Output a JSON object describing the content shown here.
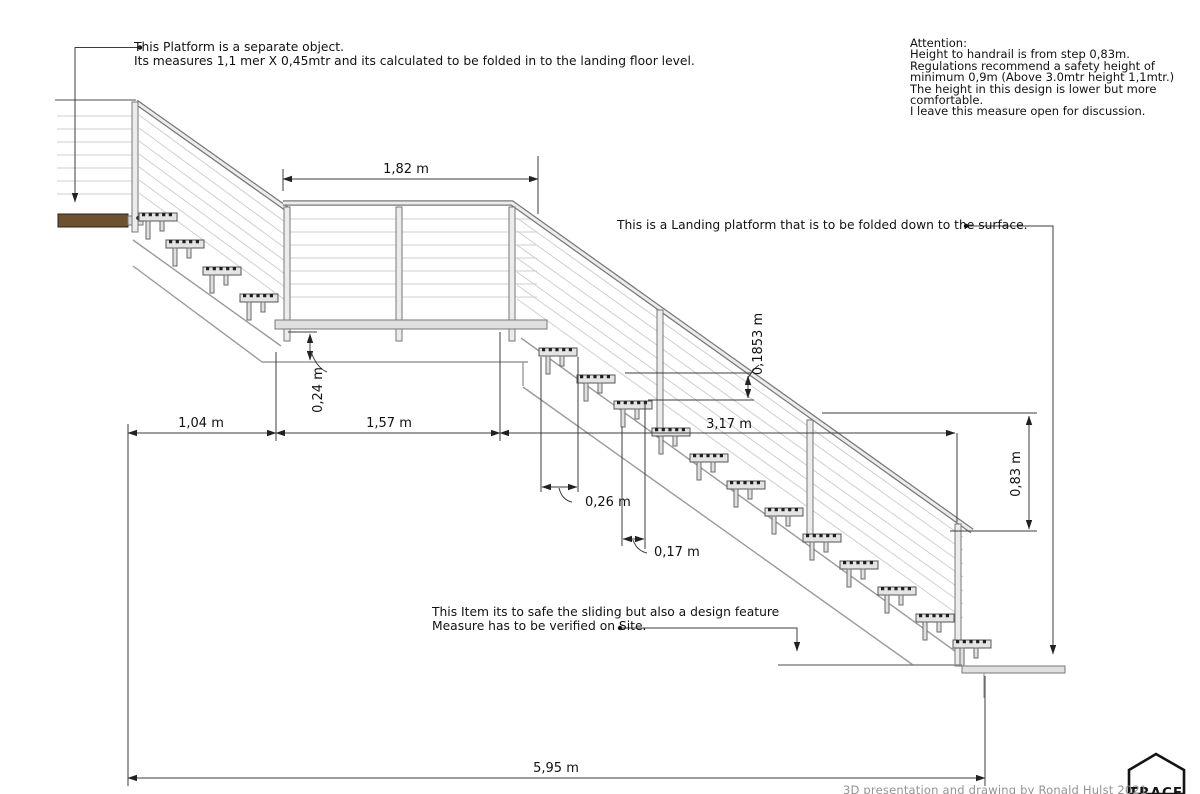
{
  "notes": {
    "platform": [
      "This Platform is a separate object.",
      "Its measures 1,1 mer X 0,45mtr and its calculated to be folded in to the landing floor level."
    ],
    "attention": [
      "Attention:",
      "Height to handrail is from step 0,83m.",
      "Regulations recommend a safety height of",
      "minimum 0,9m (Above 3.0mtr height 1,1mtr.)",
      "The height in this design is lower but more",
      "comfortable.",
      "I leave this measure open for discussion."
    ],
    "landing": "This is a Landing platform that is to be folded down to the surface.",
    "slider": [
      "This Item its to safe the sliding but also a design feature",
      "Measure has to be verified on Site."
    ]
  },
  "dimensions": {
    "landing_width": "1,82 m",
    "platform_thickness": "0,24 m",
    "upper_run": "1,04 m",
    "landing_run": "1,57 m",
    "lower_run": "3,17 m",
    "riser": "0,1853 m",
    "tread": "0,26 m",
    "offset": "0,17 m",
    "handrail_height": "0,83 m",
    "total_run": "5,95 m"
  },
  "footer": {
    "credit": "3D presentation and drawing by Ronald Hulst 2021",
    "logo": "TRACE"
  },
  "colors": {
    "line": "#3c3c3c",
    "cable": "#cfcfcf",
    "wood": "#6d5130",
    "steel": "#ececec"
  }
}
